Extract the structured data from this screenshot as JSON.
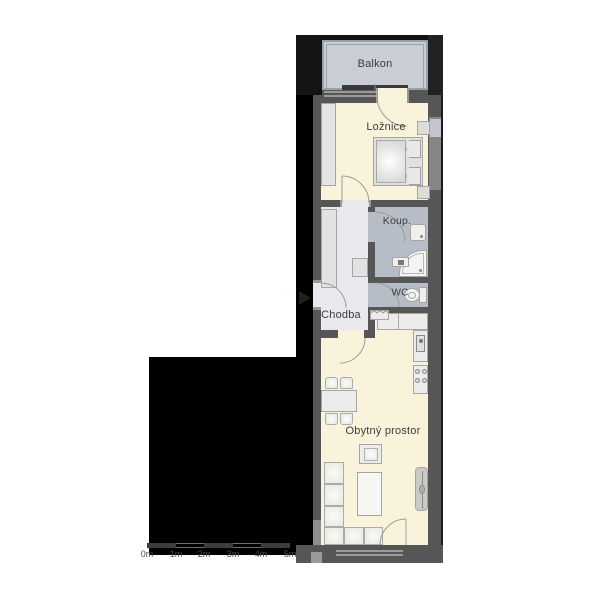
{
  "plan": {
    "title": "Apartment floor plan",
    "rooms": {
      "balkon": {
        "label": "Balkon"
      },
      "loznice": {
        "label": "Ložnice"
      },
      "koupelna": {
        "label": "Koup."
      },
      "wc": {
        "label": "WC"
      },
      "chodba": {
        "label": "Chodba"
      },
      "obytny_prostor": {
        "label": "Obytný prostor"
      }
    },
    "scale_bar": {
      "labels": [
        "0m",
        "1m",
        "2m",
        "3m",
        "4m",
        "5m"
      ]
    },
    "colors": {
      "background": "#ffffff",
      "outside_mask": "#000000",
      "wall": "#565656",
      "room_floor": "#faf3dc",
      "hall_floor": "#e9e9ed",
      "bath_floor": "#b7bdc7",
      "balcony_floor": "#c9cdd4",
      "furniture_fill": "#efefec",
      "furniture_stroke": "#a5a5a5",
      "door_arc": "#9b9b9b",
      "label_text": "#3d3d3d",
      "scale_text": "#4b4b4b"
    }
  }
}
